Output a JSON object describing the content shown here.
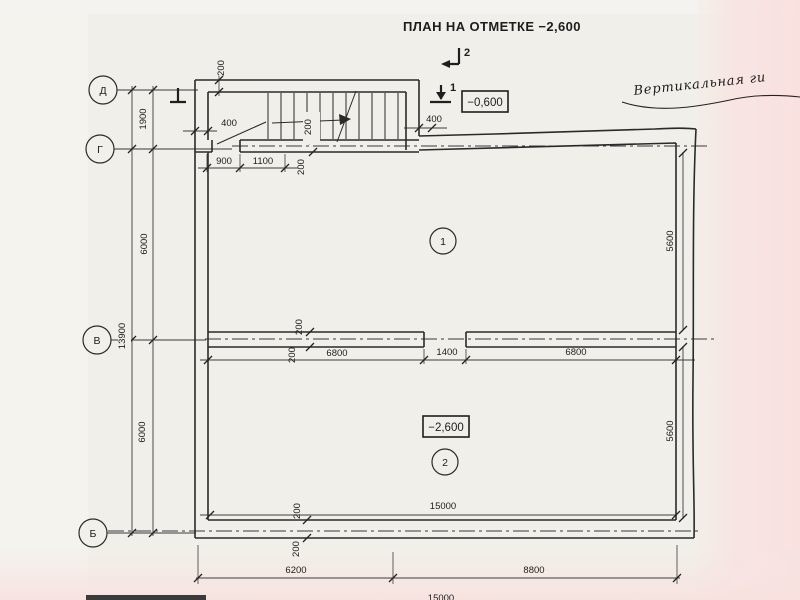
{
  "title": "ПЛАН НА ОТМЕТКЕ −2,600",
  "note": "Вертикальная ги",
  "levels": {
    "upper": "−0,600",
    "lower": "−2,600"
  },
  "sections": {
    "cut_2": "2",
    "cut_1": "1"
  },
  "axes": {
    "d": "Д",
    "g": "Г",
    "v": "В",
    "b": "Б"
  },
  "rooms": {
    "r1": "1",
    "r2": "2"
  },
  "dims": {
    "d_g": "1900",
    "g_v": "6000",
    "v_b": "6000",
    "total_height": "13900",
    "top_wall": "200",
    "stair_left": "400",
    "stair_right": "400",
    "stair_wall_a": "200",
    "stair_wall_b": "200",
    "door_a": "900",
    "door_b": "1100",
    "mid_wall_a": "200",
    "mid_wall_b": "200",
    "mid_left": "6800",
    "mid_gap": "1400",
    "mid_right": "6800",
    "room1_depth": "5600",
    "room2_depth": "5600",
    "inner_width": "15000",
    "bottom_wall_a": "200",
    "bottom_wall_b": "200",
    "span_left": "6200",
    "span_right": "8800",
    "total_width": "15000"
  },
  "colors": {
    "paper": "#f1efe9",
    "pink_edge": "#f8e2e1",
    "ink": "#2a2a2a"
  }
}
